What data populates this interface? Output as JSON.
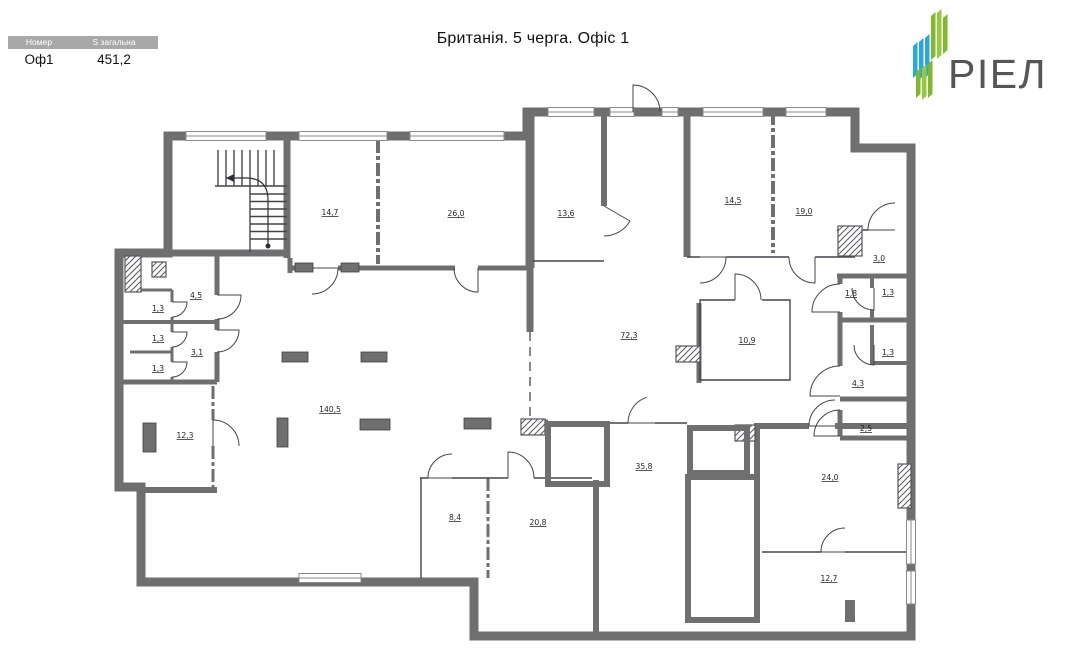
{
  "title": "Британія. 5 черга. Офіс 1",
  "info_table": {
    "headers": [
      "Номер",
      "S загальна"
    ],
    "row": {
      "number": "Оф1",
      "total_area": "451,2"
    }
  },
  "logo": {
    "text": "РІЕЛ",
    "text_color": "#55565a",
    "green": "#7fba28",
    "green_light": "#97c93d",
    "blue": "#29a8df"
  },
  "plan": {
    "floor_fill": "#dceef0",
    "wall_color": "#6f6f6f",
    "rooms": [
      {
        "id": "14-7",
        "area": "14,7",
        "x": 330,
        "y": 215
      },
      {
        "id": "26-0",
        "area": "26,0",
        "x": 456,
        "y": 216
      },
      {
        "id": "13-6",
        "area": "13,6",
        "x": 566,
        "y": 216
      },
      {
        "id": "14-5",
        "area": "14,5",
        "x": 733,
        "y": 203
      },
      {
        "id": "19-0",
        "area": "19,0",
        "x": 804,
        "y": 214
      },
      {
        "id": "3-0",
        "area": "3,0",
        "x": 879,
        "y": 261
      },
      {
        "id": "1-8",
        "area": "1,8",
        "x": 851,
        "y": 296
      },
      {
        "id": "1-3-a",
        "area": "1,3",
        "x": 888,
        "y": 295
      },
      {
        "id": "1-3-b",
        "area": "1,3",
        "x": 888,
        "y": 355
      },
      {
        "id": "4-3",
        "area": "4,3",
        "x": 858,
        "y": 386
      },
      {
        "id": "2-5",
        "area": "2,5",
        "x": 866,
        "y": 431
      },
      {
        "id": "72-3",
        "area": "72,3",
        "x": 629,
        "y": 338
      },
      {
        "id": "10-9",
        "area": "10,9",
        "x": 747,
        "y": 343
      },
      {
        "id": "4-5",
        "area": "4,5",
        "x": 196,
        "y": 298
      },
      {
        "id": "1-3-c",
        "area": "1,3",
        "x": 158,
        "y": 311
      },
      {
        "id": "1-3-d",
        "area": "1,3",
        "x": 158,
        "y": 341
      },
      {
        "id": "1-3-e",
        "area": "1,3",
        "x": 158,
        "y": 371
      },
      {
        "id": "3-1",
        "area": "3,1",
        "x": 197,
        "y": 355
      },
      {
        "id": "12-3",
        "area": "12,3",
        "x": 185,
        "y": 438
      },
      {
        "id": "140-5",
        "area": "140,5",
        "x": 330,
        "y": 412
      },
      {
        "id": "8-4",
        "area": "8,4",
        "x": 455,
        "y": 520
      },
      {
        "id": "20-8",
        "area": "20,8",
        "x": 538,
        "y": 525
      },
      {
        "id": "35-8",
        "area": "35,8",
        "x": 644,
        "y": 469
      },
      {
        "id": "24-0",
        "area": "24,0",
        "x": 830,
        "y": 480
      },
      {
        "id": "12-7",
        "area": "12,7",
        "x": 829,
        "y": 581
      }
    ]
  }
}
